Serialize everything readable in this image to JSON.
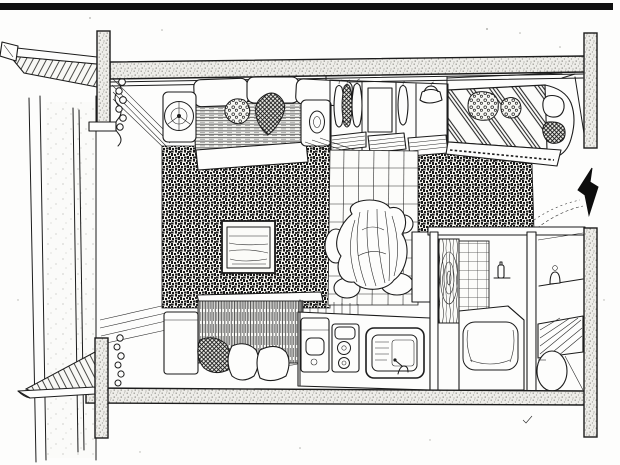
{
  "scene": {
    "type": "hand-drawn axonometric cutaway illustration of a one-room apartment",
    "style": "black ink line art on white paper, scanned",
    "colors": {
      "ink": "#1c1c1c",
      "paper": "#fdfdfc",
      "top_bar": "#101010",
      "arrow": "#0d0d0d",
      "concrete_fill": "#eeede9",
      "concrete_dot": "#91918b",
      "carpet_dark": "#181818"
    },
    "structure": {
      "top_border_bar": "solid black bar across top edge",
      "upper_slab": "stippled concrete ceiling slab",
      "lower_slab": "stippled concrete floor slab",
      "columns": [
        "upper-left column",
        "lower-left column",
        "upper-right wall",
        "lower-right wall"
      ],
      "balcony": [
        "hatched roof overhang with gutter",
        "hatched slatted balcony floor",
        "tall window with curtain rings"
      ]
    },
    "rooms": [
      {
        "name": "living-area",
        "items": [
          "sofa with three back cushions",
          "round armrest with spiral",
          "crosshatched throw pillow",
          "television in dark textured carpet wall",
          "fringed daybed cover",
          "side cabinet",
          "dark speckled cushion",
          "two white floor cushions"
        ]
      },
      {
        "name": "closet",
        "items": [
          "hanging clothes on rail",
          "dark crosshatched garment",
          "slatted shelf panels"
        ]
      },
      {
        "name": "dining-area",
        "items": [
          "tiled grid floor",
          "pile of wrapped cushions"
        ]
      },
      {
        "name": "kitchen",
        "items": [
          "washbasin unit",
          "two-burner stove",
          "sink with faucet",
          "refrigerator top"
        ]
      },
      {
        "name": "bedroom",
        "items": [
          "bed with diagonal striped duvet",
          "dotted pillows",
          "white bolster",
          "crosshatched headrest"
        ]
      },
      {
        "name": "bathroom",
        "items": [
          "wood grain door with oval spiral",
          "tiled wall",
          "bathtub with step",
          "shelf with bottle"
        ]
      },
      {
        "name": "toilet-room",
        "items": [
          "toilet bowl",
          "wall shelf with cup",
          "diagonal slatted lid"
        ]
      },
      {
        "name": "entry",
        "items": [
          "threshold dashes",
          "check mark below slab"
        ]
      }
    ],
    "icons": [
      {
        "name": "entrance-arrow-icon",
        "meaning": "solid black arrow pointing left toward apartment entrance"
      }
    ]
  }
}
